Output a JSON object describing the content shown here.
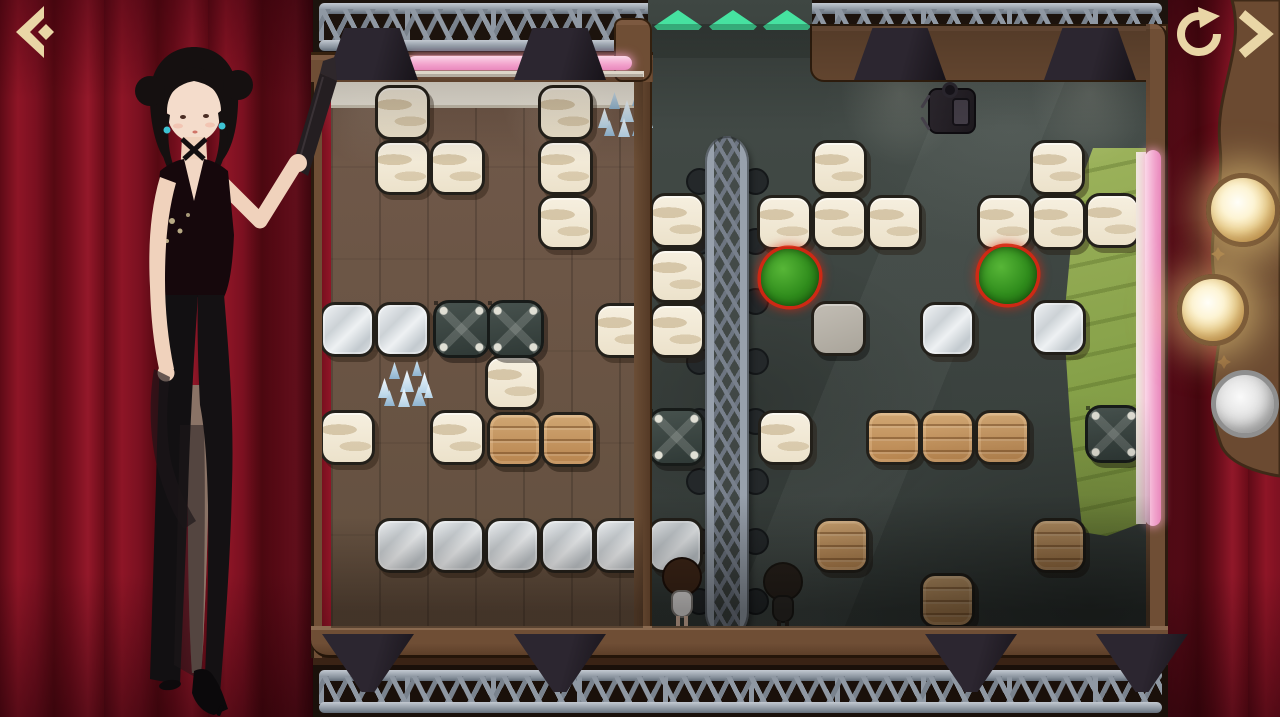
{
  "app": {
    "name": "Stage Block Puzzle",
    "screen": "level-board"
  },
  "nav": {
    "back": {
      "icon": "back-arrow",
      "color": "#e9d6a6"
    },
    "restart": {
      "icon": "restart-circular-arrow",
      "color": "#e9d6a6"
    },
    "next": {
      "icon": "next-chevron",
      "color": "#e9d6a6"
    }
  },
  "exit": {
    "arrow_color": "#46e2a0",
    "y": 10,
    "arrows": [
      {
        "x": 654
      },
      {
        "x": 709
      },
      {
        "x": 763
      }
    ]
  },
  "lamps": {
    "lit_color": "#f0d48a",
    "unlit_color": "#c7c7c7",
    "items": [
      {
        "cx": 1243,
        "cy": 210,
        "r": 37,
        "state": "lit"
      },
      {
        "cx": 1213,
        "cy": 310,
        "r": 36,
        "state": "lit"
      },
      {
        "cx": 1245,
        "cy": 404,
        "r": 34,
        "state": "unlit"
      }
    ]
  },
  "palette": {
    "curtain_red": "#7a1020",
    "gold_icon": "#e9d6a6",
    "neon_pink": "#f2a2cc",
    "mat_green": "#8aa84e",
    "bush_green": "#2f8c1c",
    "bush_outline_red": "#d72812",
    "slate_floor": "#3c433f",
    "wood_floor": "#6b5646"
  },
  "board": {
    "blocks": [
      {
        "type": "cream",
        "x": 375,
        "y": 85
      },
      {
        "type": "cream",
        "x": 375,
        "y": 140
      },
      {
        "type": "cream",
        "x": 430,
        "y": 140
      },
      {
        "type": "cream",
        "x": 538,
        "y": 85
      },
      {
        "type": "cream",
        "x": 538,
        "y": 140
      },
      {
        "type": "cream",
        "x": 538,
        "y": 195
      },
      {
        "type": "cream",
        "x": 650,
        "y": 193
      },
      {
        "type": "cream",
        "x": 650,
        "y": 248
      },
      {
        "type": "cream",
        "x": 595,
        "y": 303
      },
      {
        "type": "cream",
        "x": 650,
        "y": 303
      },
      {
        "type": "cream",
        "x": 485,
        "y": 355
      },
      {
        "type": "cream",
        "x": 320,
        "y": 410
      },
      {
        "type": "cream",
        "x": 430,
        "y": 410
      },
      {
        "type": "cream",
        "x": 758,
        "y": 410
      },
      {
        "type": "cream",
        "x": 812,
        "y": 140
      },
      {
        "type": "cream",
        "x": 757,
        "y": 195
      },
      {
        "type": "cream",
        "x": 812,
        "y": 195
      },
      {
        "type": "cream",
        "x": 867,
        "y": 195
      },
      {
        "type": "cream",
        "x": 1030,
        "y": 140
      },
      {
        "type": "cream",
        "x": 977,
        "y": 195
      },
      {
        "type": "cream",
        "x": 1031,
        "y": 195
      },
      {
        "type": "cream",
        "x": 1085,
        "y": 193
      },
      {
        "type": "silver",
        "x": 320,
        "y": 302
      },
      {
        "type": "silver",
        "x": 375,
        "y": 302
      },
      {
        "type": "silver",
        "x": 375,
        "y": 518
      },
      {
        "type": "silver",
        "x": 430,
        "y": 518
      },
      {
        "type": "silver",
        "x": 485,
        "y": 518
      },
      {
        "type": "silver",
        "x": 540,
        "y": 518
      },
      {
        "type": "silver",
        "x": 594,
        "y": 518
      },
      {
        "type": "silver",
        "x": 648,
        "y": 518
      },
      {
        "type": "silver",
        "x": 920,
        "y": 302
      },
      {
        "type": "silver",
        "x": 1031,
        "y": 300
      },
      {
        "type": "stone",
        "x": 811,
        "y": 301
      },
      {
        "type": "wood",
        "x": 487,
        "y": 412
      },
      {
        "type": "wood",
        "x": 541,
        "y": 412
      },
      {
        "type": "wood",
        "x": 866,
        "y": 410
      },
      {
        "type": "wood",
        "x": 920,
        "y": 410
      },
      {
        "type": "wood",
        "x": 975,
        "y": 410
      },
      {
        "type": "wood",
        "x": 814,
        "y": 518
      },
      {
        "type": "wood",
        "x": 1031,
        "y": 518
      },
      {
        "type": "wood",
        "x": 920,
        "y": 573
      }
    ],
    "tables": [
      {
        "x": 433,
        "y": 300
      },
      {
        "x": 487,
        "y": 300
      },
      {
        "x": 648,
        "y": 408
      },
      {
        "x": 1085,
        "y": 405
      }
    ],
    "bushes": [
      {
        "x": 761,
        "y": 249
      },
      {
        "x": 979,
        "y": 247
      }
    ],
    "crystals": [
      {
        "x": 596,
        "y": 86
      },
      {
        "x": 376,
        "y": 356
      }
    ],
    "npcs": [
      {
        "type": "girl",
        "x": 661,
        "y": 557
      },
      {
        "type": "shadow",
        "x": 762,
        "y": 562
      }
    ],
    "camera": {
      "x": 916,
      "y": 80
    },
    "lights_top": [
      {
        "x": 326
      },
      {
        "x": 514
      },
      {
        "x": 854
      },
      {
        "x": 1044
      }
    ],
    "lights_bottom": [
      {
        "x": 322
      },
      {
        "x": 514
      },
      {
        "x": 925
      },
      {
        "x": 1096
      }
    ],
    "truss_bump_ys": [
      168,
      228,
      288,
      348,
      408,
      468,
      528,
      588
    ]
  }
}
